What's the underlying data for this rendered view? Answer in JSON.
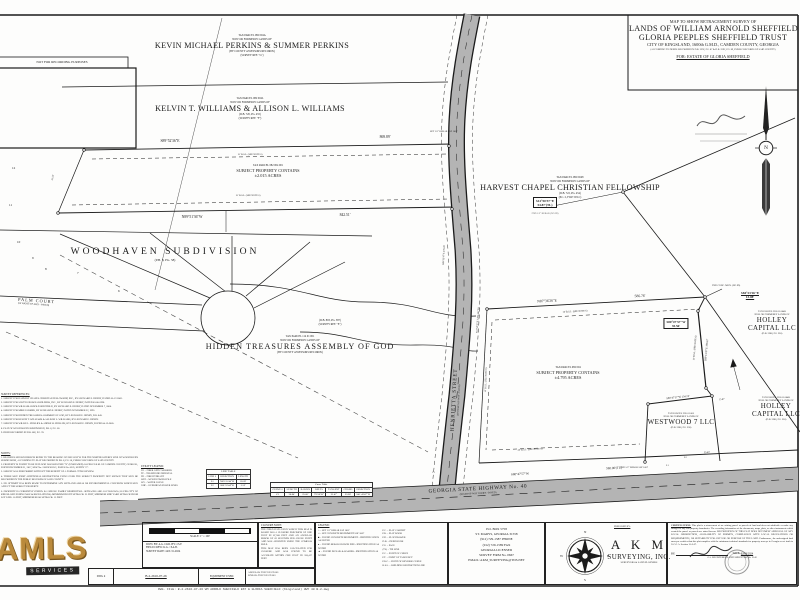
{
  "sheet": {
    "not_for_recording": "NOT FOR RECORDING PURPOSES",
    "file_line": "DWG. FILE: B-2-2616-07-26 WM ARNOLD SHEFFIELD EST & GLORIA SHEFFIELD (Kingsland) HWY 40 B-2.dwg"
  },
  "title_block": {
    "line1": "MAP TO SHOW RETRACEMENT SURVEY OF",
    "line2": "LANDS OF WILLIAM ARNOLD SHEFFIELD ESTATE &",
    "line3": "GLORIA PEEPLES SHEFFIELD TRUST",
    "line4": "CITY OF KINGSLAND, 1600th G.M.D., CAMDEN COUNTY, GEORGIA",
    "line5": "(ACCORDING TO DEEDS RECORDED IN D.B. 2292, PG. 87 & D.B. 2292, PG. 89, PUBLIC RECORDS OF SAID COUNTY)",
    "for_line": "FOR: ESTATE OF GLORIA SHEFFIELD"
  },
  "parcels": {
    "perkins": {
      "lines": [
        "TAX PARCEL 082 004A",
        "NOW OR FORMERLY LANDS OF",
        "KEVIN MICHAEL PERKINS & SUMMER PERKINS",
        "(BY COUNTY ASSESSORS RECORDS)",
        "(SURVEY REF. \"G\")"
      ]
    },
    "williams": {
      "lines": [
        "TAX PARCEL 082 004L",
        "NOW OR FORMERLY LANDS OF",
        "KELVIN T. WILLIAMS & ALLISON L. WILLIAMS",
        "(D.B. 720, PG. 455)",
        "(SURVEY REF. \"F\")"
      ]
    },
    "subject1": {
      "lines": [
        "TAX PARCEL 082 004 001",
        "SUBJECT PROPERTY CONTAINS",
        "±2.015 ACRES"
      ]
    },
    "harvest": {
      "lines": [
        "TAX PARCEL 082 004N",
        "NOW OR FORMERLY LANDS OF",
        "HARVEST CHAPEL CHRISTIAN FELLOWSHIP",
        "(D.B. 722, PG. 454)",
        "(P.C. 2, FILE 503-C)"
      ]
    },
    "hidden_ref": {
      "lines": [
        "(D.B. 893, PG. 387)",
        "(SURVEY REF. \"E\")"
      ]
    },
    "hidden": {
      "lines": [
        "TAX PARCEL 114 01 001",
        "NOW OR FORMERLY LANDS OF",
        "HIDDEN TREASURES ASSEMBLY OF GOD",
        "(BY COUNTY ASSESSORS RECORDS)"
      ]
    },
    "subject2": {
      "lines": [
        "TAX PARCEL 082 004",
        "SUBJECT PROPERTY CONTAINS",
        "±4.795 ACRES"
      ]
    },
    "holley1": {
      "lines": [
        "TAX PARCEL H15 01 004B",
        "NOW OR FORMERLY LANDS OF",
        "HOLLEY",
        "CAPITAL LLC",
        "(D.B. 2288, PG. 230)"
      ]
    },
    "holley2": {
      "lines": [
        "TAX PARCEL H15 01 004B",
        "NOW OR FORMERLY LANDS OF",
        "HOLLEY",
        "CAPITAL LLC",
        "(D.B. 2286, PG. 230)"
      ]
    },
    "westwood": {
      "lines": [
        "TAX PARCEL H15 01 005",
        "NOW OR FORMERLY LANDS OF",
        "WESTWOOD 7 LLC",
        "(D.B. 2286, PG. 230)"
      ]
    },
    "woodhaven": {
      "name": "WOODHAVEN SUBDIVISION",
      "ref": "(P.B. 8, PG. 58)",
      "lots": [
        "12",
        "11",
        "10",
        "9",
        "8",
        "7",
        "6"
      ]
    }
  },
  "roads": {
    "henrietta": {
      "name": "HENRIETTA STREET",
      "row": "(60' RIGHT-OF-WAY - PAVED)"
    },
    "highway": {
      "name": "GEORGIA STATE HIGHWAY No. 40",
      "row": "(RIGHT-OF-WAY VARIES - PAVED)"
    },
    "palm": {
      "name": "PALM COURT",
      "row": "(50' RIGHT-OF-WAY - PAVED)"
    }
  },
  "dims": {
    "strip_top_brg": "S89°52'36\"E",
    "strip_top_len": "869.89'",
    "strip_bot_brg": "N89°51'36\"W",
    "strip_bot_len": "842.51'",
    "bsl15": "15' B.S.L. (SEE NOTE 6)",
    "bsl25": "25' B.S.L. (SEE NOTE 6)",
    "tie1_brg": "S12°50'37\"E",
    "tie1_len": "54.87'(TL)",
    "s2_top_brg": "N87°36'26\"E",
    "s2_top_len": "586.76'",
    "jog_brg": "S80°47'57\"W",
    "jog_len": "35.56'",
    "corner_brg": "S84°23'26\"E",
    "corner_len": "13.08'",
    "right_line": "S09°13'47\"E  198.67'",
    "ww_top": "S80°47'57\"W  134.74'",
    "ww_top2": "15.87'",
    "hwy_brg": "S80°47'57\"W",
    "hwy_len": "580.00'(TL)",
    "hwy_len2": "55.60'",
    "road_brg1": "S09°13'47\"E  278.28'",
    "road_brg2": "S12°50'37\"E  1,854.66'(TL)",
    "left_len": "41.52'",
    "c1": "C1",
    "l1": "L1",
    "l2": "L2"
  },
  "markers": {
    "m1": "FND 1/2\" REBAR (NO ID)",
    "m2": "SET 1/2\" REBAR LSF 1067",
    "m3": "FND CONC. MON. (NO ID)",
    "m4": "FND 1/2\" REBAR LSF 1067"
  },
  "utility_legend": {
    "title": "UTILITY LEGEND:",
    "items": [
      "FO = FIBER OPTIC MARKER",
      "TP = TELEPHONE PEDESTAL",
      "FH = FIRE HYDRANT",
      "WPP = WOOD POWER POLE",
      "WV = WATER VALVE",
      "OHP = OVERHEAD POWER LINES"
    ]
  },
  "line_table": {
    "title": "LINE TABLE",
    "headers": [
      "LINE #",
      "DIRECTION",
      "LENGTH"
    ],
    "rows": [
      [
        "L1",
        "N09°15'44\"W",
        "20.09'"
      ],
      [
        "L2",
        "S80°55'44\"W",
        "5.53'"
      ]
    ]
  },
  "curve_table": {
    "title": "Curve Table",
    "headers": [
      "CURVE #",
      "LENGTH",
      "RADIUS",
      "DELTA",
      "TANGENT",
      "CHORD",
      "DIRECTION"
    ],
    "rows": [
      [
        "C1",
        "36.84'",
        "25.00'",
        "79°58'18\"",
        "21.47'",
        "33.08'",
        "S41°43'47\"W"
      ]
    ]
  },
  "references": {
    "title": "SURVEY REFERENCES:",
    "items": [
      "1. SURVEY FOR HARVEST CHAPEL CHRISTIAN FELLOWSHIP, INC., BY LEONARD E. HENRY, DATED 05-17-2002.",
      "2. SURVEY FOR SOUTH GEORGIA BUILDERS, INC., BY LEONARD E. HENRY, DATED 03-06-1998.",
      "3. SURVEY FOR WILLIAM ARNOLD SHEFFIELD, BY LEONARD E. HENRY, DATED NOVEMBER 7, 2000.",
      "4. SURVEY FOR MIKE FARMER, BY LEONARD E. HENRY, DATED NOVEMBER 22, 1993.",
      "5. SURVEY FOR HIDDEN TREASURES ASSEMBLY OF GOD, BY LEONARD E. HENRY, D.B. 843.",
      "6. SURVEY FOR KELVIN T. WILLIAMS & ALLISON L. WILLIAMS, BY LEONARD E. HENRY.",
      "7. SURVEY FOR WILLIE L. PHILLIPS & ANDRE W. PHILLIPS, BY LEONARD E. HENRY, DATED 04-12-2005.",
      "8. PLAT OF WOODHAVEN SUBDIVISION, P.B. 8, PG. 58.",
      "9. DEED RECORDED IN D.B. 882, PG. 78."
    ]
  },
  "notes": {
    "title": "NOTES:",
    "items": [
      "1. BEARINGS SHOWN HEREON REFER TO THE BEARING OF N09°55'09\"W FOR THE NORTHEASTERLY LINE OF WOODHAVEN SUBDIVISION, ACCORDING TO PLAT RECORDED IN P.B. 8, PG. 58, PUBLIC RECORDS OF SAID COUNTY.",
      "2. PROPERTY IS FOUND TO BE IN FLOOD HAZARD ZONE \"X\" (UNSHADED) AS PER F.I.R.M. OF CAMDEN COUNTY, GEORGIA, DATED DECEMBER 21, 2017, MAP No. 13039C0325G, PANEL No. 0325, SUFFIX \"G\".",
      "3. SURVEY WAS PERFORMED WITHOUT THE BENEFIT OF A FORMAL TITLE REVIEW.",
      "4. THERE MAY EXIST ADDITIONAL RESTRICTIONS LYING OVER THE SUBJECT PROPERTY NOT SHOWN THAT MAY BE RECORDED IN THE PUBLIC RECORDS OF SAID COUNTY.",
      "5. NO ATTEMPT HAS BEEN MADE TO DETERMINE ANY WETLAND AREAS OR ENVIRONMENTAL CONCERNS WHICH MAY AFFECT THE SUBJECT PROPERTY.",
      "6. PROPERTY IS CURRENTLY ZONED: R-1 SINGLE FAMILY RESIDENTIAL. SETBACKS ARE AS FOLLOWS (AS PER CITY OF KINGSLAND ZONING MAP & REGULATIONS): MINIMUM FRONT SETBACK: 25 FEET, MINIMUM SIDE YARD SETBACK FROM LOT LINE: 10 FEET, MINIMUM REAR SETBACK: 15 FEET."
    ]
  },
  "scale_box": {
    "caption": "SCALE: 1\" = 100'"
  },
  "admin_box": {
    "drawn": "DWN. BY:  A.G.        CKD. BY:  J.S.F.",
    "crew": "FIELD CREW:  K.G. / P.A.B.",
    "survey_date": "SURVEY DATE:  JAN-31-2024",
    "dwg_label": "DWG #",
    "dwg_value": "B-2-2616-07-26",
    "equipment_label": "EQUIPMENT USED:",
    "equipment_lines": [
      "ANGULAR:  TOPCON GT-503",
      "LINEAR:  TOPCON GT-503"
    ]
  },
  "closure": {
    "title": "CLOSURE NOTE:",
    "p1": "THE FIELD DATA UPON WHICH THIS MAP IS BASED HAS A CLOSURE PRECISION OF ONE FOOT IN 87,568 FEET AND AN ANGULAR ERROR OF 02 SECONDS PER ANGLE POINT AND WAS ADJUSTED USING THE COMPASS RULE.",
    "p2": "THIS MAP HAS BEEN CALCULATED FOR CLOSURE AND WAS FOUND TO BE ACCURATE WITHIN ONE FOOT IN 318,417 FEET."
  },
  "legend": {
    "title": "LEGEND:",
    "symbols": [
      "○ = SET 1/2\" REBAR LSF 1067",
      "□ = SET CONCRETE MONUMENT LSF 1067",
      "■ = FOUND CONCRETE MONUMENT - IDENTIFICATION AS NOTED",
      "● = FOUND REBAR OR IRON PIPE - IDENTIFICATION AS NOTED",
      "▲ = FOUND PK NAIL & WASHER - IDENTIFICATION AS NOTED"
    ],
    "abbrevs": [
      "P.C. = PLAT CABINET",
      "P.B. = PLAT BOOK",
      "P.D. = PLAT DRAWER",
      "D.B. = DEED BOOK",
      "PG. = PAGE",
      "(TL) = TIE LINE",
      "P.C. = POINT OF CURVE",
      "P.T. = POINT OF TANGENCY",
      "P.R.C. = POINT OF REVERSE CURVE",
      "B.S.L. = BUILDING RESTRICTION LINE"
    ]
  },
  "address": {
    "lines": [
      "P.O. BOX 5758",
      "ST. MARYS, GEORGIA 31558",
      "(912) 729-1587 PHONE",
      "(912) 729-1589 FAX",
      "GEORGIA LICENSED",
      "SURVEY FIRM No. 0667",
      "EMAIL: AKM_SURVEYING@TDS.NET"
    ]
  },
  "company": {
    "prepared_by": "PREPARED BY:",
    "name": "A K M",
    "name2": "SURVEYING, INC.",
    "tagline": "SURVEYORS & LAND PLANNERS",
    "compass": {
      "n": "N",
      "e": "E",
      "s": "S",
      "w": "W"
    }
  },
  "certification": {
    "label": "CERTIFICATION:",
    "text": "This plat is a retracement of an existing parcel or parcels of land and does not subdivide or make any changes to any real property boundaries. The recording information of the documents, maps, plats, or other instruments which created the parcel or parcels are stated hereon. RECORDATION OF THIS PLAT DOES NOT IMPLY APPROVAL OF ANY LOCAL JURISDICTION, AVAILABILITY OF PERMITS, COMPLIANCE WITH LOCAL REGULATIONS OR REQUIREMENTS, OR SUITABILITY FOR ANY USE OR PURPOSE OF THE LAND. Furthermore, the undersigned land surveyor certifies that this plat complies with the minimum technical standards for property surveys in Georgia as set forth in O.C.G.A. Section 15-6-67.",
    "by_label": "BY:",
    "date_label": "DATE:",
    "date": "03/03/2024",
    "surveyor_line": "GA. REGISTERED LAND SURVEYOR No. 3142"
  },
  "watermark": {
    "text": "AMLS",
    "sub": "SERVICES"
  },
  "north": {
    "n": "N"
  }
}
